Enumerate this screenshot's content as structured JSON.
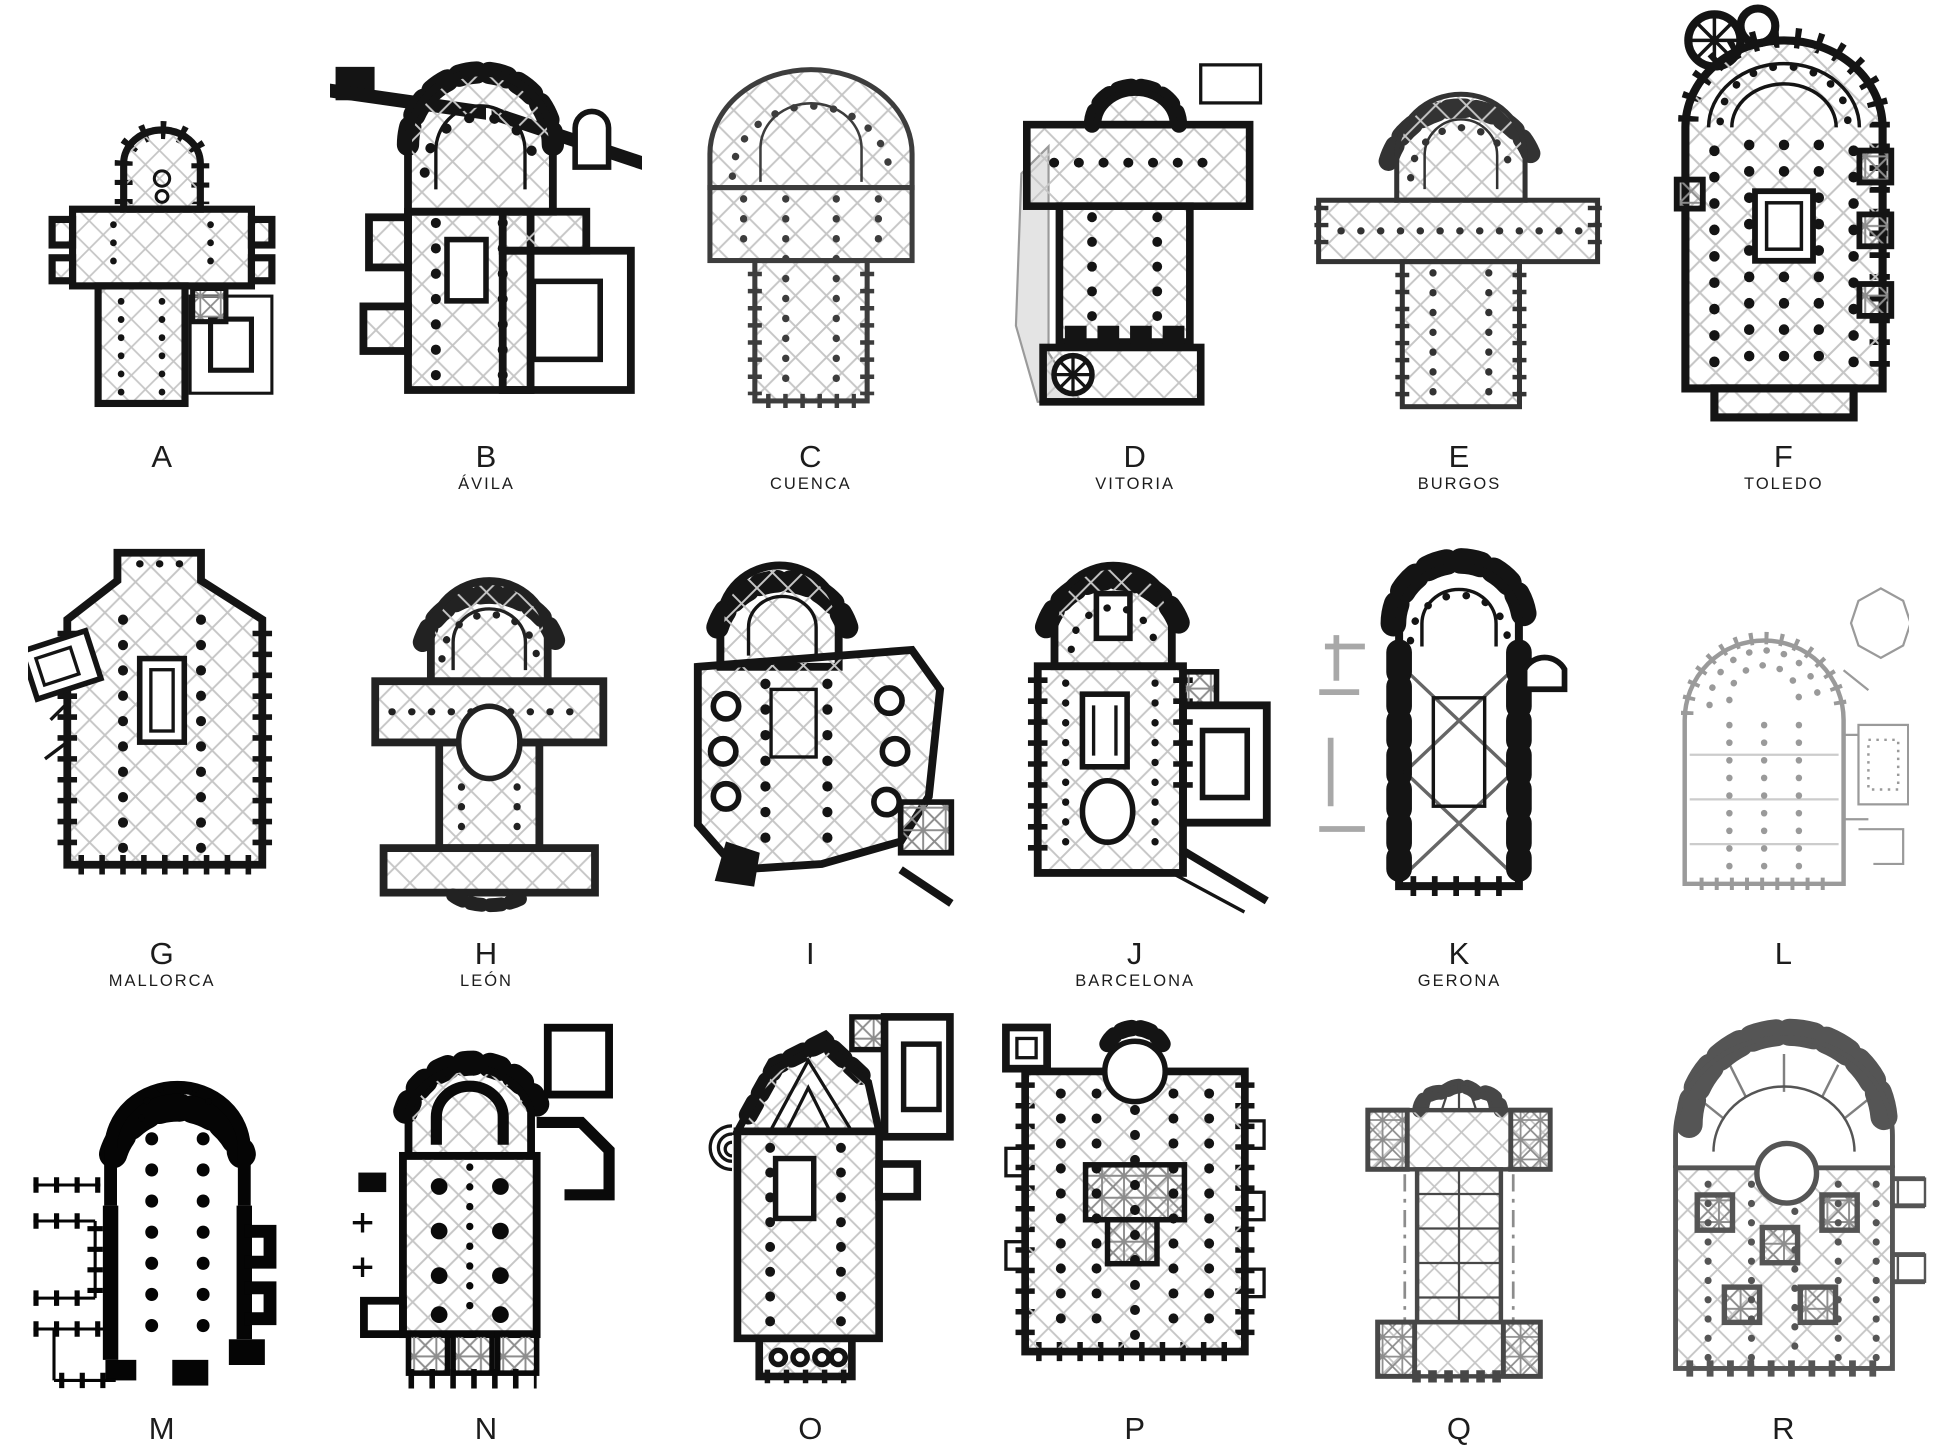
{
  "page": {
    "background": "#ffffff",
    "ink": "#1c1c1c"
  },
  "figure": {
    "rows": 3,
    "columns": 6,
    "drawing_type": "gothic-cathedral-floor-plan"
  },
  "plans": [
    {
      "letter": "A",
      "name": ""
    },
    {
      "letter": "B",
      "name": "ÁVILA"
    },
    {
      "letter": "C",
      "name": "CUENCA"
    },
    {
      "letter": "D",
      "name": "VITORIA"
    },
    {
      "letter": "E",
      "name": "BURGOS"
    },
    {
      "letter": "F",
      "name": "TOLEDO"
    },
    {
      "letter": "G",
      "name": "MALLORCA"
    },
    {
      "letter": "H",
      "name": "LEÓN"
    },
    {
      "letter": "I",
      "name": ""
    },
    {
      "letter": "J",
      "name": "BARCELONA"
    },
    {
      "letter": "K",
      "name": "GERONA"
    },
    {
      "letter": "L",
      "name": ""
    },
    {
      "letter": "M",
      "name": ""
    },
    {
      "letter": "N",
      "name": ""
    },
    {
      "letter": "O",
      "name": ""
    },
    {
      "letter": "P",
      "name": ""
    },
    {
      "letter": "Q",
      "name": ""
    },
    {
      "letter": "R",
      "name": ""
    }
  ]
}
